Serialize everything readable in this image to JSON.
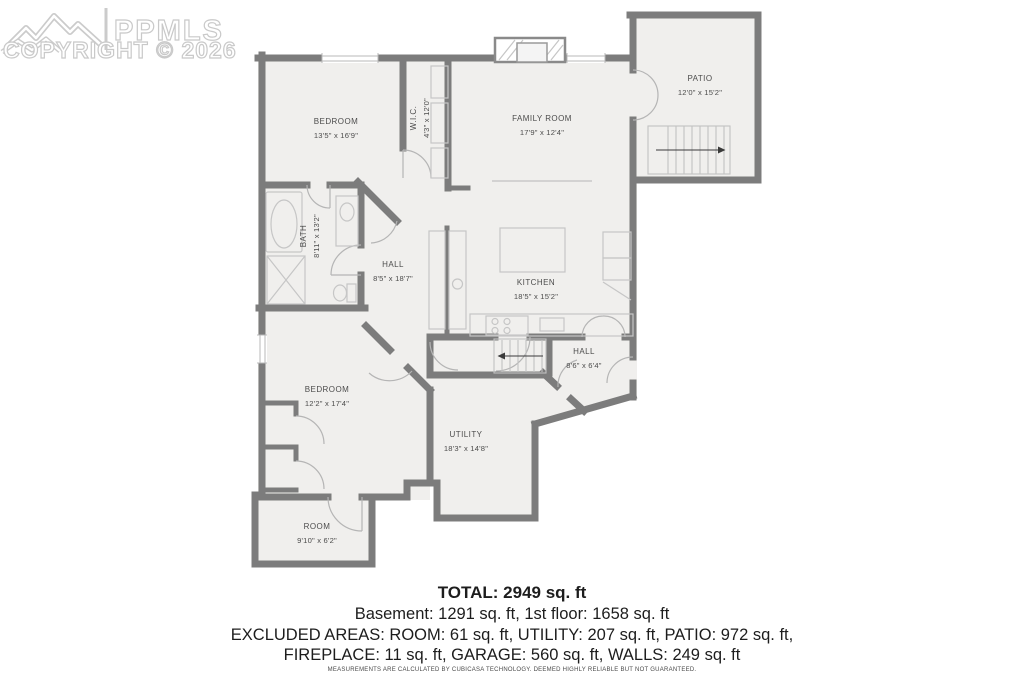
{
  "watermark": {
    "brand": "PPMLS",
    "copyright": "COPYRIGHT © 2026",
    "logo_icon": "mountain-logo"
  },
  "rooms": {
    "bedroom_upper": {
      "name": "BEDROOM",
      "dims": "13'5\" x 16'9\""
    },
    "wic": {
      "name": "W.I.C.",
      "dims": "4'3\" x 12'0\""
    },
    "family_room": {
      "name": "FAMILY ROOM",
      "dims": "17'9\" x 12'4\""
    },
    "patio": {
      "name": "PATIO",
      "dims": "12'0\" x 15'2\""
    },
    "bath": {
      "name": "BATH",
      "dims": "8'11\" x 13'2\""
    },
    "hall_main": {
      "name": "HALL",
      "dims": "8'5\" x 18'7\""
    },
    "kitchen": {
      "name": "KITCHEN",
      "dims": "18'5\" x 15'2\""
    },
    "hall_lower": {
      "name": "HALL",
      "dims": "8'6\" x 6'4\""
    },
    "bedroom_lower": {
      "name": "BEDROOM",
      "dims": "12'2\" x 17'4\""
    },
    "utility": {
      "name": "UTILITY",
      "dims": "18'3\" x 14'8\""
    },
    "room": {
      "name": "ROOM",
      "dims": "9'10\" x 6'2\""
    }
  },
  "summary": {
    "total": "TOTAL: 2949 sq. ft",
    "floors": "Basement: 1291 sq. ft, 1st floor: 1658 sq. ft",
    "excluded_1": "EXCLUDED AREAS: ROOM: 61 sq. ft, UTILITY: 207 sq. ft, PATIO: 972 sq. ft,",
    "excluded_2": "FIREPLACE: 11 sq. ft, GARAGE: 560 sq. ft, WALLS: 249 sq. ft",
    "disclaimer": "MEASUREMENTS ARE CALCULATED BY CUBICASA TECHNOLOGY. DEEMED HIGHLY RELIABLE BUT NOT GUARANTEED."
  },
  "colors": {
    "wall": "#7c7c7c",
    "floor": "#f0efed",
    "fixture": "#c6c6c6",
    "label": "#4c4c4c",
    "watermark": "#c9c9c9"
  }
}
